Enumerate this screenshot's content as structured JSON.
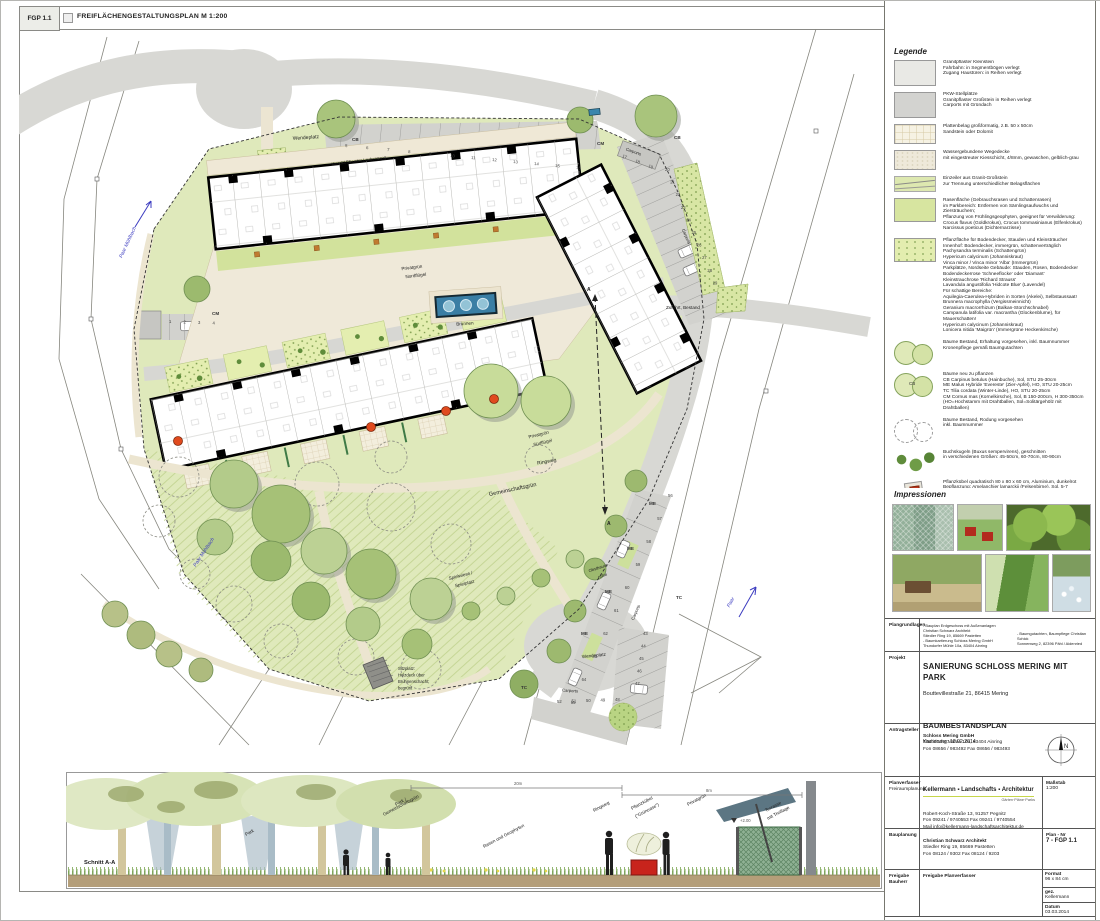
{
  "header": {
    "code": "FGP 1.1",
    "title": "FREIFLÄCHENGESTALTUNGSPLAN  M 1:200"
  },
  "plan": {
    "labels": {
      "wendeplatz_top": "Wendeplatz",
      "wendeplatz_bottom": "Wendeplatz",
      "kies": "Kies 32/56 unter Laubengang",
      "privatgruen_nord_1": "Privatgrün",
      "privatgruen_nord_2": "Nordflügel",
      "privatgruen_sued_1": "Privatgrün",
      "privatgruen_sued_2": "Südflügel",
      "brunnen": "Brunnen",
      "zufahrt": "Zufahrt, Bestand",
      "ringweg": "Ringweg",
      "gemeinschaftsgruen": "Gemeinschaftsgrün",
      "spielwiese_1": "Spielwiese /",
      "spielwiese_2": "Spielplatz",
      "obstbaum_1": "Obstbaum-",
      "obstbaum_2": "reihe",
      "sitzplatz_1": "Sitzplatz:",
      "sitzplatz_2": "Holzdeck über",
      "sitzplatz_3": "Brunnenschacht;",
      "sitzplatz_4": "begrünt",
      "carports": "Carports",
      "paar_muehlbach": "Paar Mühlbach",
      "paar": "Paar",
      "section_marker": "A"
    },
    "parking_rows": [
      {
        "nums": [
          "5",
          "6",
          "7",
          "8",
          "9",
          "10",
          "11",
          "12",
          "13",
          "14",
          "15",
          "16"
        ],
        "x": 326,
        "y": 118,
        "dx": 21,
        "dy": 2,
        "rot": 5
      },
      {
        "nums": [
          "17",
          "18",
          "19"
        ],
        "x": 603,
        "y": 128,
        "dx": 13,
        "dy": 5,
        "rot": 22
      },
      {
        "nums": [
          "20",
          "21",
          "22",
          "23",
          "24",
          "25",
          "26",
          "27",
          "28",
          "29"
        ],
        "x": 646,
        "y": 142,
        "dx": 5.3,
        "dy": 12.6,
        "rot": 0
      },
      {
        "nums": [
          "1",
          "2",
          "3",
          "4"
        ],
        "x": 150,
        "y": 294,
        "dx": 14.5,
        "dy": 0.5,
        "rot": 0
      },
      {
        "nums": [
          "56",
          "57",
          "58",
          "59",
          "60",
          "61",
          "62",
          "63",
          "64",
          "65"
        ],
        "x": 649,
        "y": 468,
        "dx": -10.8,
        "dy": 23,
        "rot": 0
      },
      {
        "nums": [
          "43",
          "44",
          "45",
          "46",
          "47"
        ],
        "x": 624,
        "y": 606,
        "dx": -2,
        "dy": 12.5,
        "rot": 0
      },
      {
        "nums": [
          "48",
          "49",
          "50",
          "51",
          "52"
        ],
        "x": 596,
        "y": 672,
        "dx": -14.5,
        "dy": 0.5,
        "rot": 0
      }
    ],
    "tree_tags": [
      {
        "t": "CB",
        "x": 333,
        "y": 112
      },
      {
        "t": "CM",
        "x": 578,
        "y": 116
      },
      {
        "t": "CB",
        "x": 655,
        "y": 110
      },
      {
        "t": "CM",
        "x": 193,
        "y": 286
      },
      {
        "t": "ME",
        "x": 630,
        "y": 476
      },
      {
        "t": "ME",
        "x": 608,
        "y": 521
      },
      {
        "t": "ME",
        "x": 586,
        "y": 564
      },
      {
        "t": "ME",
        "x": 562,
        "y": 606
      },
      {
        "t": "TC",
        "x": 657,
        "y": 570
      },
      {
        "t": "TC",
        "x": 502,
        "y": 660
      }
    ]
  },
  "section": {
    "labels": {
      "schnitt": "Schnitt A-A",
      "park": "Park",
      "park_gg_1": "Park /",
      "park_gg_2": "Gemeinschaftsgrün",
      "rasen": "Rasen und Geophyten",
      "ringweg": "Ringweg",
      "kuebel_1": "Pflanzkübel",
      "kuebel_2": "(\"Grünoase\")",
      "privatgruen": "Privatgrün",
      "terrasse_1": "Terrasse",
      "terrasse_2": "mit Treillage",
      "d20": "20m",
      "d8": "8m",
      "level": "+2.00"
    }
  },
  "legend": {
    "heading": "Legende",
    "items": [
      {
        "type": "pflaster-klein",
        "text": "Granitpflaster Kleinstein\nFahrbahn: in Segmentbögen verlegt\nZugang Haustüren: in Reihen verlegt"
      },
      {
        "type": "pflaster-gross",
        "text": "PKW-Stellplätze\nGranitpflaster Großstein in Reihen verlegt\nCarports mit Gründach"
      },
      {
        "type": "platten",
        "text": "Plattenbelag großformatig, z.B. 50 x 50cm\nSandstein oder Dolomit"
      },
      {
        "type": "wegedecke",
        "text": "Wassergebundene Wegedecke\nmit eingestreuter Kiesschicht, 4/8mm, gewaschen, gelblich-grau"
      },
      {
        "type": "einzeiler",
        "text": "Einzeiler aus Granit-Großstein\nzur Trennung unterschiedlicher Belagsflächen"
      },
      {
        "type": "rasen",
        "text": "Rasenfläche (Gebrauchsrasen und Schattenrasen)\nim Parkbereich: Entfernen von Sämlingsaufwuchs und Ziersträuchern;\nPflanzung von Frühlingsgeophyten, geeignet für Verwilderung:\nCrocus flavus (Goldkrokus), Crocus tommasinianus (Elfenkrokus)\nNarcissus poeticus (Dichternarzisse)"
      },
      {
        "type": "pflanzflaeche",
        "text": "Pflanzfläche für Bodendecker, Stauden und Kleinsträucher\nInnenhof: Bodendecker, immergrün, schattenverträglich\nPachysandra terminalis (Schattengrün)\nHypericum calycinum (Johanniskraut)\nVinca minor / Vinca minor 'Alba' (Immergrün)\nParkplätze, Nordseite Gebäude: Stauden, Rosen, Bodendecker\nBodendeckerrose 'Schneeflocke' oder 'Diamant'\nKleinstrauchrose 'Richard Strauss'\nLavandula angustifolia 'Hidcote Blue' (Lavendel)\nFür schattige Bereiche:\nAquilegia-Caerulea-Hybriden in Sorten (Akelei), Selbstaussaat!\nBrunnera macrophylla (Vergissmeinnicht)\nGeranium macrorrhizum (Balkan-Storchschnabel)\nCampanula latifolia var. macrantha (Glockenblume), für Mauerschatten!\nHypericum calycinum (Johanniskraut)\nLonicera nitida 'Maigrün' (Immergrüne Heckenkirsche)"
      },
      {
        "type": "baum-bestand",
        "text": "Bäume Bestand, Erhaltung vorgesehen, inkl. Baumnummer\nKronenpflege gemäß Baumgutachten"
      },
      {
        "type": "baum-neu",
        "tag": "CB",
        "text": "Bäume neu zu pflanzen\nCB   Carpinus betulus (Hainbuche), Sol, STU 25-30cm\nME   Malus Hybride 'Evereste' (Zier-Apfel), HO, STU 20-25cm\nTC   Tilia cordata (Winter-Linde), HO, STU 20-25cm\nCM   Cornus mas (Kornelkirsche), Sol, B 150-200cm, H 300-350cm\n(HO=Hochstamm mit Drahtballen, Sol=Solitärgehölz mit Drahtballen)"
      },
      {
        "type": "baum-rodung",
        "text": "Bäume Bestand, Rodung vorgesehen\ninkl. Baumnummer"
      },
      {
        "type": "buchs",
        "text": "Buchskugeln (Buxus sempervirens), geschnitten\nin verschiedenen Größen: 45-50cm, 60-70cm, 80-90cm"
      },
      {
        "type": "kuebel",
        "text": "Pflanzkübel quadratisch 80 x 80 x 60 cm, Aluminium, dunkelrot\nBepflanzung: Amelanchier lamarckii (Felsenbirne), Sol, 5-7 Grundstämme,\nH 150-200cm, Unterpflanzung, z.B. Geranium renardii\nStellfläche: 4 Terrassenplatten à 50 x 50 cm"
      },
      {
        "type": "treillage",
        "text": "Sichtschutz / Treillage aus Holz, H = 2.00m, grün lasiert,\nbeidseitig begrünbar mit Spreizklimmern, z.B. Kletterrosen oder Jasmin"
      },
      {
        "type": "zaun",
        "text": "Zaun; Bestand wird saniert\nH = ca. 1,40m"
      },
      {
        "type": "bank",
        "text": "Bänke\nim Innenhof ohne Rückenlehne, im Park mit Rückenlehne"
      },
      {
        "type": "brunnen",
        "text": "Brunnen mit drei Fontainen\nEinfassung aus Sandstein oder Dolomit (analog Terrassen), H = 45cm"
      }
    ]
  },
  "impressionen": {
    "heading": "Impressionen",
    "photos": [
      {
        "type": "trellis"
      },
      {
        "type": "planters"
      },
      {
        "type": "buxus"
      },
      {
        "type": "bench"
      },
      {
        "type": "hedge"
      },
      {
        "type": "flowers"
      }
    ]
  },
  "titleblock": {
    "plangrundlagen": {
      "label": "Plangrundlagen",
      "col1": "- Bauplan Erdgeschoss mit Außenanlagen\nChristian Schwarz Architekt\nStiedler Ring 19, 85669 Pastetten\n- Baumkartierung Schloss Mering GmbH\nThundorfer Mühle 10a, 83404 Ainring",
      "col2": "- Baumgutachten, Baumpflege Christian Schick\nSonnenweg 2, 82396 Pähl / Aidenried"
    },
    "projekt": {
      "label": "Projekt",
      "title": "SANIERUNG SCHLOSS MERING MIT PARK",
      "address": "Bouttevillestraße 21, 86415 Mering",
      "subtitle": "BAUMBESTANDSPLAN",
      "note": "Kartierung: 18.02.2014"
    },
    "antragsteller": {
      "label": "Antragsteller",
      "name": "Schloss Mering GmbH",
      "lines": "Thundorfer Mühle 10a, 83404 Ainring\nFon 08656 / 983492   Fax 08656 / 983493",
      "compass_n": "N"
    },
    "planverfasser": {
      "label": "Planverfasser",
      "sublabel": "Freiraumplanung",
      "firm": "Kellermann ▪ Landschafts ▪ Architektur",
      "tagline": "Gärten·Pläne·Parks",
      "lines": "Robert-Koch-Straße 13, 91257 Pegnitz\nFon 09241 / 9740553   Fax 09241 / 9740554\nMail info@kellermann-landschaftsarchitektur.de",
      "scale_label": "Maßstab",
      "scale_value": "1:200"
    },
    "bauplanung": {
      "label": "Bauplanung",
      "name": "Christian Schwarz Architekt",
      "lines": "Stiedler Ring 19, 85669 Pastetten\nFon 08124 / 9302   Fax 08124 / 9203",
      "plannr_label": "Plan - Nr",
      "plannr_value": "7 - FGP 1.1"
    },
    "freigabe": {
      "label": "Freigabe",
      "sublabel": "Bauherr",
      "content": "Freigabe Planverfasser",
      "format_label": "Format",
      "format_value": "96 x 84 cm",
      "gez_label": "gez.",
      "gez_value": "Kellermann",
      "datum_label": "Datum",
      "datum_value": "03.03.2014"
    }
  }
}
